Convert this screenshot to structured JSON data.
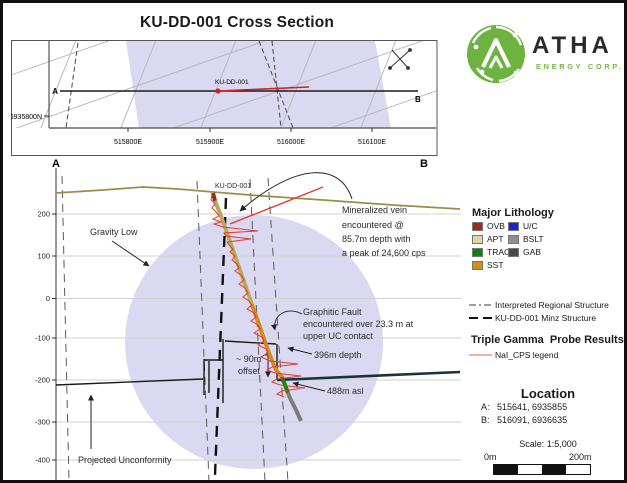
{
  "title": "KU-DD-001 Cross Section",
  "logo": {
    "brand": "ATHA",
    "subtitle": "ENERGY CORP."
  },
  "colors": {
    "logo_green": "#6cb33f",
    "gravity_low_fill": "#dbd9f2",
    "topography": "#9d8c48",
    "gamma_red": "#e23b30",
    "unconformity_right": "#17333b"
  },
  "map": {
    "a_label": "A",
    "b_label": "B",
    "hole_label": "KU-DD-001",
    "north_tick": "6935800N",
    "east_ticks": [
      "515800E",
      "515900E",
      "516000E",
      "516100E"
    ]
  },
  "section": {
    "a_label": "A",
    "b_label": "B",
    "hole_label": "KU-DD-001",
    "elev_ticks": [
      "200",
      "100",
      "0",
      "-100",
      "-200",
      "-300",
      "-400"
    ],
    "ann": {
      "gravity": "Gravity Low",
      "min1": "Mineralized vein",
      "min2": "encountered @",
      "min3": "85.7m depth with",
      "min4": "a peak of 24,600 cps",
      "gf1": "Graphitic Fault",
      "gf2": "encountered  over 23.3 m at",
      "gf3": "upper UC contact",
      "depth": "396m depth",
      "asl": "488m asl",
      "off1": "~ 90m",
      "off2": "offset",
      "unconf": "Projected Unconformity"
    }
  },
  "legend": {
    "lith_title": "Major Lithology",
    "col1": [
      {
        "label": "OVB",
        "color": "#9e2a1f"
      },
      {
        "label": "APT",
        "color": "#ded7a4"
      },
      {
        "label": "TRAC",
        "color": "#0f8511"
      },
      {
        "label": "SST",
        "color": "#d29018"
      }
    ],
    "col2": [
      {
        "label": "U/C",
        "color": "#1b23cf"
      },
      {
        "label": "BSLT",
        "color": "#8e8e8e"
      },
      {
        "label": "GAB",
        "color": "#4a4a4a"
      }
    ],
    "struct1": "Interpreted Regional Structure",
    "struct2": "KU-DD-001 Minz Structure",
    "gamma_title": "Triple Gamma  Probe Results",
    "gamma_item": "NaI_CPS legend",
    "location_title": "Location",
    "loc_a": "A:   515641, 6935855",
    "loc_b": "B:   516091, 6936635",
    "scale_text": "Scale: 1:5,000",
    "scale_left": "0m",
    "scale_right": "200m"
  }
}
